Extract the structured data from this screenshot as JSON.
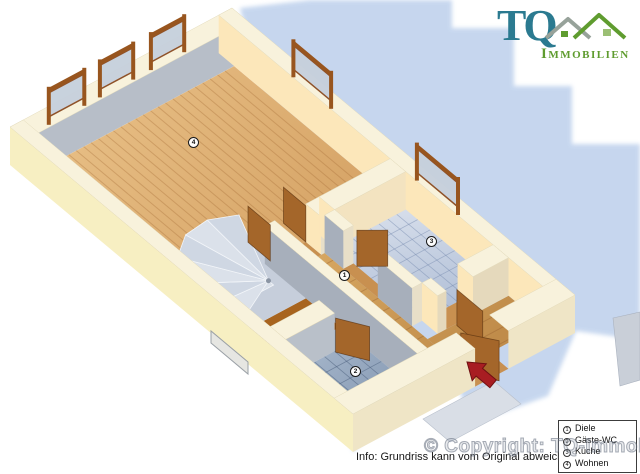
{
  "logo": {
    "tq": "TQ",
    "name": "Immobilien"
  },
  "info_text": "Info: Grundriss kann vom Original abweichen!",
  "watermark": "© Copyright: TQ-Immobilien",
  "legend": {
    "items": [
      {
        "num": "1",
        "label": "Diele"
      },
      {
        "num": "2",
        "label": "Gäste-WC"
      },
      {
        "num": "3",
        "label": "Küche"
      },
      {
        "num": "4",
        "label": "Wohnen"
      }
    ]
  },
  "markers": [
    {
      "num": "1",
      "room": "Diele",
      "x": 345,
      "y": 276
    },
    {
      "num": "2",
      "room": "Gäste-WC",
      "x": 356,
      "y": 372
    },
    {
      "num": "3",
      "room": "Küche",
      "x": 432,
      "y": 242
    },
    {
      "num": "4",
      "room": "Wohnen",
      "x": 194,
      "y": 143
    }
  ],
  "colors": {
    "wall_top": "#f8f2dc",
    "wall_sw_outer": "#f7efc2",
    "wall_se_outer": "#efe5c6",
    "wall_inner_gray": "#b7bec8",
    "wall_inner_warm": "#fce7ba",
    "wall_slab_gray": "#a7afbb",
    "wall_inner_soft": "#e8dfc8",
    "wood_light": "#e9c188",
    "wood_dark": "#d5a264",
    "wood_diele_a": "#d8a862",
    "wood_diele_b": "#c08c4a",
    "wood_threshold": "#c89050",
    "wood_landing": "#a8641e",
    "tile_k1": "#d9e0ec",
    "tile_k2": "#a8b8d2",
    "tile_wc1": "#a8b8cc",
    "tile_wc2": "#8498b2",
    "stair_light": "#dbe1ea",
    "stair_mid": "#cfd7e3",
    "stair_bg": "#c6cedb",
    "door_brown": "#a4662a",
    "frame_brown": "#98551e",
    "glass": "#c6d0dc",
    "arrow_red": "#a81d22",
    "shadow_blue": "#bdd0ec",
    "walkway": "#d9dee6",
    "panel_gray": "#c9cfd8",
    "logo_teal": "#2b7a90",
    "logo_green": "#5f9c2f"
  }
}
